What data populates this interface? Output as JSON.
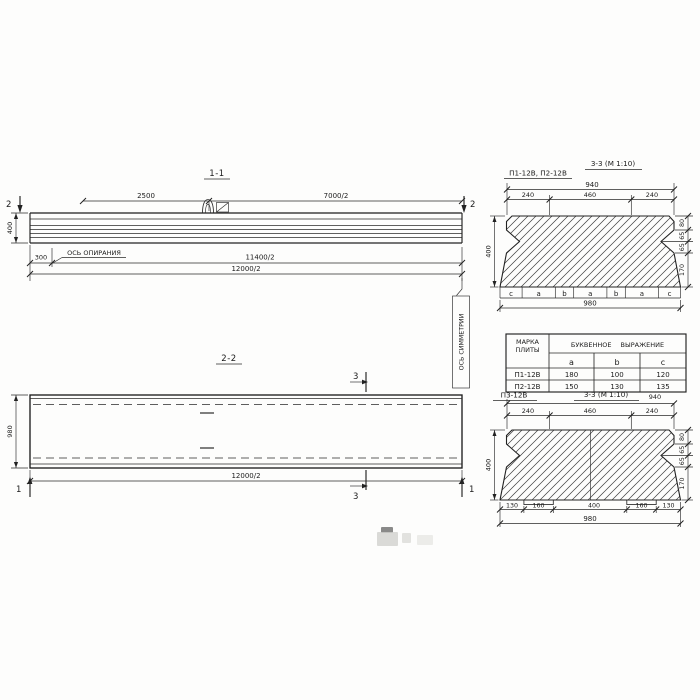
{
  "drawing": {
    "view_1_1": {
      "title": "1-1",
      "dim_2500": "2500",
      "dim_7000_half": "7000/2",
      "dim_400": "400",
      "dim_300": "300",
      "dim_11400_half": "11400/2",
      "dim_12000_half": "12000/2",
      "cut_label_left": "2",
      "cut_label_right": "2",
      "support_axis_label": "ОСЬ ОПИРАНИЯ"
    },
    "view_2_2": {
      "title": "2-2",
      "dim_980": "980",
      "dim_12000_half": "12000/2",
      "cut_label_3_top": "3",
      "cut_label_3_bottom": "3",
      "cut_label_1_left": "1",
      "cut_label_1_right": "1",
      "symmetry_axis_label": "ОСЬ СИММЕТРИИ"
    },
    "section_p1_p2": {
      "marks_label": "П1-12В, П2-12В",
      "title": "3-3 (М 1:10)",
      "dim_940": "940",
      "dims_top": [
        "240",
        "460",
        "240"
      ],
      "dims_right": [
        "80",
        "65",
        "65",
        "170"
      ],
      "dim_400": "400",
      "letter_row": [
        "c",
        "a",
        "b",
        "a",
        "b",
        "a",
        "c"
      ],
      "dim_980": "980"
    },
    "table": {
      "col_mark_line1": "МАРКА",
      "col_mark_line2": "ПЛИТЫ",
      "header_expression": "БУКВЕННОЕ ВЫРАЖЕНИЕ",
      "letter_headers": [
        "a",
        "b",
        "c"
      ],
      "rows": [
        {
          "mark": "П1-12В",
          "a": "180",
          "b": "100",
          "c": "120"
        },
        {
          "mark": "П2-12В",
          "a": "150",
          "b": "130",
          "c": "135"
        }
      ]
    },
    "section_p3": {
      "mark_label": "П3-12В",
      "title": "3-3 (М 1:10)",
      "dim_940": "940",
      "dims_top": [
        "240",
        "460",
        "240"
      ],
      "dims_right": [
        "80",
        "65",
        "65",
        "170"
      ],
      "dim_400": "400",
      "dims_bottom": [
        "130",
        "160",
        "400",
        "160",
        "130"
      ],
      "dim_980": "980"
    }
  }
}
